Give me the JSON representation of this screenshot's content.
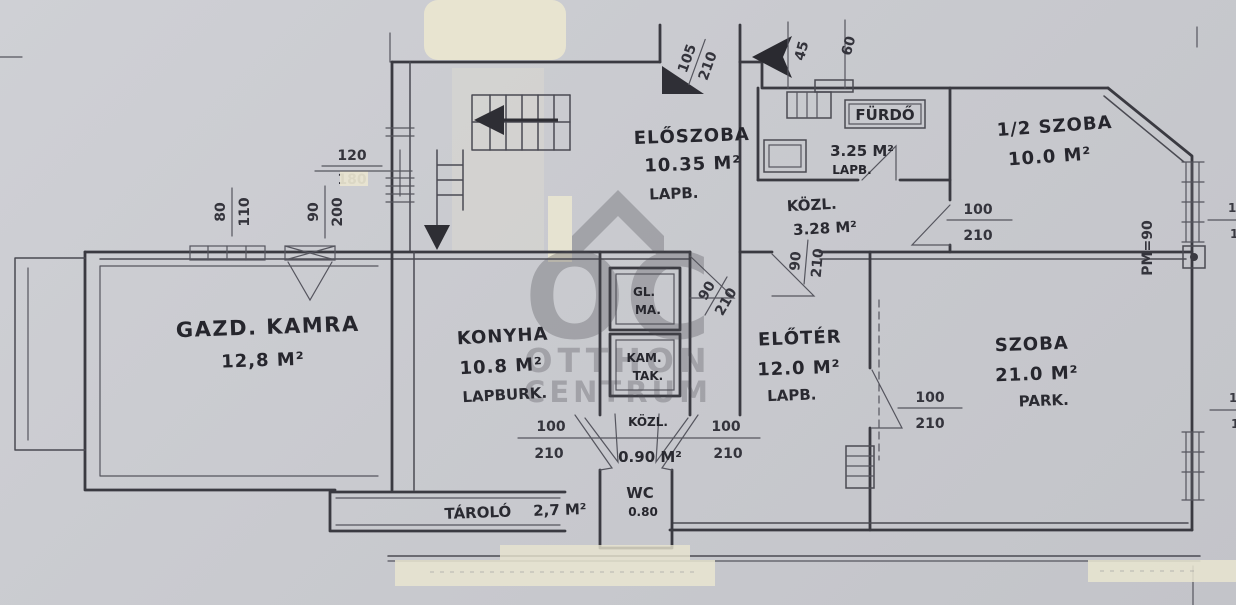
{
  "watermark": {
    "monogram": "OC",
    "line1": "OTTHON",
    "line2": "CENTRUM"
  },
  "rooms": {
    "eloszoba": {
      "name": "ELŐSZOBA",
      "area": "10.35 M²",
      "floor": "LAPB."
    },
    "furdo": {
      "name": "FÜRDŐ",
      "area": "3.25 M²",
      "floor": "LAPB."
    },
    "kozl_felso": {
      "name": "KÖZL.",
      "area": "3.28 M²"
    },
    "fel_szoba": {
      "name": "1/2 SZOBA",
      "area": "10.0 M²"
    },
    "gazd_kamra": {
      "name": "GAZD. KAMRA",
      "area": "12,8 M²"
    },
    "konyha": {
      "name": "KONYHA",
      "area": "10.8 M²",
      "floor": "LAPBURK."
    },
    "eloter": {
      "name": "ELŐTÉR",
      "area": "12.0 M²",
      "floor": "LAPB."
    },
    "szoba": {
      "name": "SZOBA",
      "area": "21.0 M²",
      "floor": "PARK."
    },
    "tarolo": {
      "name": "TÁROLÓ",
      "area": "2,7 M²"
    },
    "kozl_also": {
      "name": "KÖZL.",
      "area": "0.90 M²"
    },
    "wc": {
      "name": "WC",
      "area": "0.80"
    },
    "shaft_felso": {
      "line1": "GL.",
      "line2": "MA."
    },
    "shaft_also": {
      "line1": "KAM.",
      "line2": "TAK."
    }
  },
  "dimensions": {
    "left_window": {
      "w": "80",
      "h": "110"
    },
    "left_door": {
      "w": "90",
      "h": "200"
    },
    "top_window": {
      "w": "120",
      "h": "180"
    },
    "entry_door": {
      "w": "105",
      "h": "210"
    },
    "step_a": "45",
    "step_b": "60",
    "felszoba_door": {
      "w": "100",
      "h": "210"
    },
    "kozl_door_a": {
      "w": "90",
      "h": "210"
    },
    "kozl_door_b": {
      "w": "90",
      "h": "210"
    },
    "szoba_door": {
      "w": "100",
      "h": "210"
    },
    "konyha_door_left": {
      "w": "100",
      "h": "210"
    },
    "konyha_door_right": {
      "w": "100",
      "h": "210"
    },
    "parapet": "PM=90",
    "edge_fragment": "1"
  }
}
